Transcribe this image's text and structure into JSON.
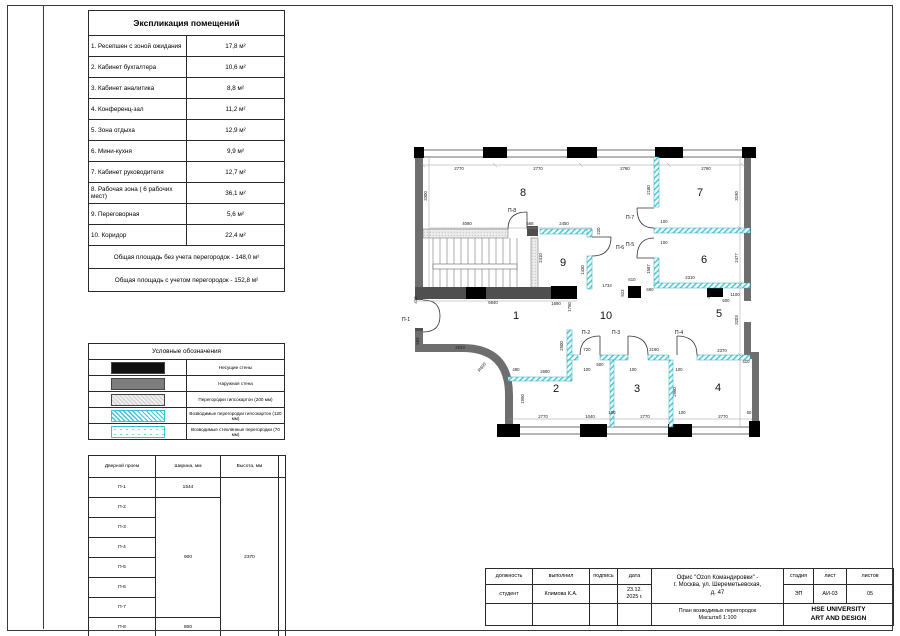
{
  "explication": {
    "title": "Экспликация помещений",
    "rows": [
      {
        "name": "1. Ресепшен с зоной ожидания",
        "area": "17,8 м²"
      },
      {
        "name": "2. Кабинет бухгалтера",
        "area": "10,6 м²"
      },
      {
        "name": "3. Кабинет аналитика",
        "area": "8,8 м²"
      },
      {
        "name": "4. Конференц-зал",
        "area": "11,2 м²"
      },
      {
        "name": "5. Зона отдыха",
        "area": "12,9 м²"
      },
      {
        "name": "6. Мини-кухня",
        "area": "9,9 м²"
      },
      {
        "name": "7. Кабинет руководителя",
        "area": "12,7 м²"
      },
      {
        "name": "8. Рабочая зона ( 6 рабочих мест)",
        "area": "36,1 м²"
      },
      {
        "name": "9. Переговорная",
        "area": "5,6 м²"
      },
      {
        "name": "10. Коридор",
        "area": "22,4 м²"
      }
    ],
    "totals": [
      "Общая площадь без учета перегородок - 148,0 м²",
      "Общая площадь с учетом перегородок - 152,8 м²"
    ]
  },
  "legend": {
    "title": "Условные обозначения",
    "items": [
      {
        "swatch": "black-fill",
        "label": "Несущие стены"
      },
      {
        "swatch": "gray-fill",
        "label": "Наружная стена"
      },
      {
        "swatch": "gray-hatch",
        "label": "Перегородки гипсокартон (200 мм)"
      },
      {
        "swatch": "cyan-hatch",
        "label": "Возводимые перегородки гипсокартон (120 мм)"
      },
      {
        "swatch": "cyan-dots",
        "label": "Возводимые стеклянные перегородки (70 мм)"
      }
    ]
  },
  "doors_table": {
    "headers": [
      "Дверной проем",
      "Ширина, мм",
      "Высота, мм"
    ],
    "names": [
      "П-1",
      "П-2",
      "П-3",
      "П-4",
      "П-5",
      "П-6",
      "П-7",
      "П-8"
    ],
    "width_p1": "1544",
    "width_p2_p7": "900",
    "width_p8": "800",
    "height_all": "2370"
  },
  "title_block": {
    "headers": {
      "position": "должность",
      "performed": "выполнил",
      "signature": "подпись",
      "date": "дата",
      "stage": "стадия",
      "sheet": "лист",
      "sheets": "листов"
    },
    "values": {
      "position": "студент",
      "performed": "Климова К.А.",
      "signature": "",
      "date": "23.12.\n2025 г.",
      "stage": "ЭП",
      "sheet": "АИ-03",
      "sheets": "05"
    },
    "project": "Офис \"Ozon Командировки\" -\nг. Москва, ул. Шереметьевская,\nд. 47",
    "drawing_title": "План возводимых перегородок\nМасштаб 1:100",
    "org": "HSE UNIVERSITY\nART AND DESIGN"
  },
  "plan": {
    "rooms": [
      {
        "n": "8",
        "x": 523,
        "y": 196
      },
      {
        "n": "7",
        "x": 700,
        "y": 196
      },
      {
        "n": "9",
        "x": 563,
        "y": 266
      },
      {
        "n": "6",
        "x": 704,
        "y": 263
      },
      {
        "n": "1",
        "x": 516,
        "y": 319
      },
      {
        "n": "10",
        "x": 606,
        "y": 319
      },
      {
        "n": "5",
        "x": 719,
        "y": 317
      },
      {
        "n": "2",
        "x": 556,
        "y": 392
      },
      {
        "n": "3",
        "x": 637,
        "y": 392
      },
      {
        "n": "4",
        "x": 718,
        "y": 391
      }
    ],
    "door_labels": [
      {
        "t": "П-1",
        "x": 406,
        "y": 321
      },
      {
        "t": "П-8",
        "x": 512,
        "y": 212
      },
      {
        "t": "П-6",
        "x": 620,
        "y": 249
      },
      {
        "t": "П-7",
        "x": 630,
        "y": 219
      },
      {
        "t": "П-5",
        "x": 630,
        "y": 246
      },
      {
        "t": "П-2",
        "x": 586,
        "y": 334
      },
      {
        "t": "П-3",
        "x": 616,
        "y": 334
      },
      {
        "t": "П-4",
        "x": 679,
        "y": 334
      }
    ],
    "dims": [
      {
        "t": "2770",
        "x": 459,
        "y": 170
      },
      {
        "t": "2770",
        "x": 538,
        "y": 170
      },
      {
        "t": "2780",
        "x": 625,
        "y": 170
      },
      {
        "t": "2780",
        "x": 706,
        "y": 170
      },
      {
        "t": "3300",
        "x": 427,
        "y": 196,
        "r": -90
      },
      {
        "t": "3190",
        "x": 738,
        "y": 196,
        "r": -90
      },
      {
        "t": "2477",
        "x": 738,
        "y": 258,
        "r": -90
      },
      {
        "t": "3203",
        "x": 738,
        "y": 320,
        "r": -90
      },
      {
        "t": "4080",
        "x": 467,
        "y": 225
      },
      {
        "t": "568",
        "x": 530,
        "y": 225
      },
      {
        "t": "2450",
        "x": 564,
        "y": 225
      },
      {
        "t": "220",
        "x": 600,
        "y": 231,
        "r": -90
      },
      {
        "t": "2410",
        "x": 542,
        "y": 258,
        "r": -90
      },
      {
        "t": "1430",
        "x": 584,
        "y": 270,
        "r": -90
      },
      {
        "t": "5940",
        "x": 493,
        "y": 304
      },
      {
        "t": "1690",
        "x": 556,
        "y": 305
      },
      {
        "t": "1750",
        "x": 571,
        "y": 307,
        "r": -90
      },
      {
        "t": "2180",
        "x": 650,
        "y": 190,
        "r": -90
      },
      {
        "t": "100",
        "x": 664,
        "y": 223
      },
      {
        "t": "100",
        "x": 664,
        "y": 244
      },
      {
        "t": "1587",
        "x": 650,
        "y": 269,
        "r": -90
      },
      {
        "t": "1734",
        "x": 607,
        "y": 287
      },
      {
        "t": "610",
        "x": 632,
        "y": 281
      },
      {
        "t": "523",
        "x": 624,
        "y": 293,
        "r": -90
      },
      {
        "t": "690",
        "x": 650,
        "y": 291
      },
      {
        "t": "2310",
        "x": 690,
        "y": 279
      },
      {
        "t": "400",
        "x": 710,
        "y": 295,
        "r": -90
      },
      {
        "t": "600",
        "x": 726,
        "y": 302
      },
      {
        "t": "1100",
        "x": 735,
        "y": 296
      },
      {
        "t": "2370",
        "x": 722,
        "y": 352
      },
      {
        "t": "410",
        "x": 746,
        "y": 363
      },
      {
        "t": "2190",
        "x": 654,
        "y": 351
      },
      {
        "t": "720",
        "x": 587,
        "y": 351
      },
      {
        "t": "500",
        "x": 600,
        "y": 366
      },
      {
        "t": "100",
        "x": 587,
        "y": 371
      },
      {
        "t": "100",
        "x": 633,
        "y": 371
      },
      {
        "t": "100",
        "x": 679,
        "y": 371
      },
      {
        "t": "2690",
        "x": 545,
        "y": 373
      },
      {
        "t": "480",
        "x": 516,
        "y": 371
      },
      {
        "t": "2500",
        "x": 563,
        "y": 346,
        "r": -90
      },
      {
        "t": "1950",
        "x": 524,
        "y": 399,
        "r": -90
      },
      {
        "t": "2923",
        "x": 460,
        "y": 349
      },
      {
        "t": "583",
        "x": 419,
        "y": 341,
        "r": -90
      },
      {
        "t": "413",
        "x": 417,
        "y": 300,
        "r": -90
      },
      {
        "t": "R600",
        "x": 483,
        "y": 368,
        "r": -50
      },
      {
        "t": "2960",
        "x": 676,
        "y": 392,
        "r": -90
      },
      {
        "t": "2770",
        "x": 543,
        "y": 418
      },
      {
        "t": "1040",
        "x": 590,
        "y": 418
      },
      {
        "t": "100",
        "x": 612,
        "y": 414
      },
      {
        "t": "2770",
        "x": 645,
        "y": 418
      },
      {
        "t": "100",
        "x": 682,
        "y": 414
      },
      {
        "t": "2770",
        "x": 723,
        "y": 418
      },
      {
        "t": "60",
        "x": 749,
        "y": 414
      }
    ]
  }
}
